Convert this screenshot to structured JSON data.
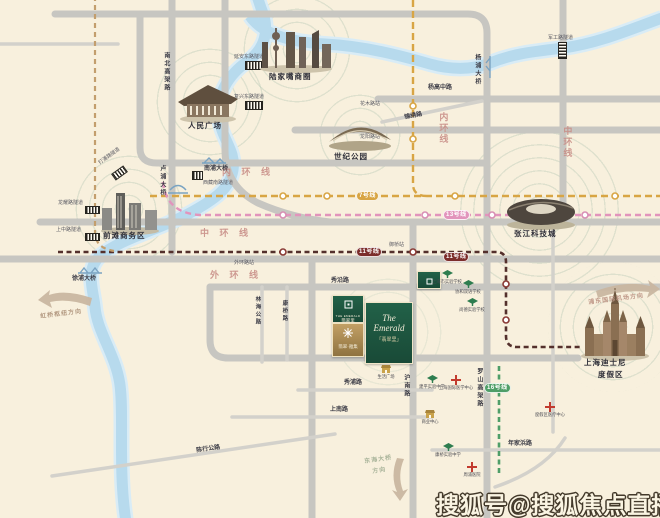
{
  "watermark": "搜狐号@搜狐焦点直播站",
  "landmarks": {
    "renmin": "人民广场",
    "lujiazui": "陆家嘴商圈",
    "shiji": "世纪公园",
    "qiantan": "前滩商务区",
    "zhangjiang": "张江科技城",
    "disney_line1": "上海迪士尼",
    "disney_line2": "度假区"
  },
  "project": {
    "script_name": "The Emerald",
    "sub_name": "「翡翠里」",
    "badge_green_en": "THE EMERALD",
    "badge_green_cn": "翡翠里",
    "badge_gold_cn": "翡翠·雅集"
  },
  "roads": {
    "nanbei_gaojia": "南北高架路",
    "yanggao_zhong": "杨高中路",
    "jinxiu": "锦绣路",
    "neihuan_h": "内 环 线",
    "neihuan_v": "内环线",
    "zhonghuan_h": "中 环 线",
    "zhonghuan_v": "中环线",
    "waihuan_h": "外 环 线",
    "xiuyan": "秀沿路",
    "xiupu": "秀浦路",
    "hunan": "沪南路",
    "shangnan": "上南路",
    "luoshan": "罗山高架路",
    "nianjiabang": "年家浜路",
    "chenhang": "陈行公路",
    "linhai": "林海公路",
    "kangqiao": "康桥路"
  },
  "bridges": {
    "lupu": "卢浦大桥",
    "nanpu": "南浦大桥",
    "xupu": "徐浦大桥",
    "yangpu": "杨浦大桥"
  },
  "tunnels": {
    "yanan": "延安东路隧道",
    "fuxing": "复兴东路隧道",
    "dapu": "打浦路隧道",
    "xizang": "西藏南路隧道",
    "longyao": "龙耀路隧道",
    "shangzhong": "上中路隧道",
    "jungong": "军工路隧道"
  },
  "metro": {
    "line7": "7号线",
    "line11": "11号线",
    "line13": "13号线",
    "line16": "16号线",
    "stations": {
      "huamu": "花木路站",
      "longyang": "龙阳路站",
      "yuqiao": "御桥站",
      "waihuan": "外环路站"
    }
  },
  "directions": {
    "hongqiao": "虹桥枢纽方向",
    "airport": "浦东国际机场方向",
    "donghai_1": "东海大桥",
    "donghai_2": "方向"
  },
  "pois": {
    "schools": [
      {
        "label": "上海市实验学校"
      },
      {
        "label": "协和双语学校"
      },
      {
        "label": "尚德实验学校"
      },
      {
        "label": "建平实验中学"
      },
      {
        "label": "康桥实验中学"
      }
    ],
    "hospitals": [
      {
        "label": "上海国际医学中心"
      },
      {
        "label": "度假区医疗中心"
      },
      {
        "label": "周浦医院"
      }
    ],
    "malls": [
      {
        "label": "生活广场"
      },
      {
        "label": "商业中心"
      }
    ]
  },
  "colors": {
    "background": "#f8f0dd",
    "river": "#b7daed",
    "road": "#c7c6c1",
    "ring_label": "#c98f88",
    "line7": "#d8a544",
    "line13": "#e294bc",
    "line11": "#7c2d2b",
    "line16": "#4f9e68",
    "project_green": "#1d5743",
    "project_gold": "#b3905a"
  }
}
